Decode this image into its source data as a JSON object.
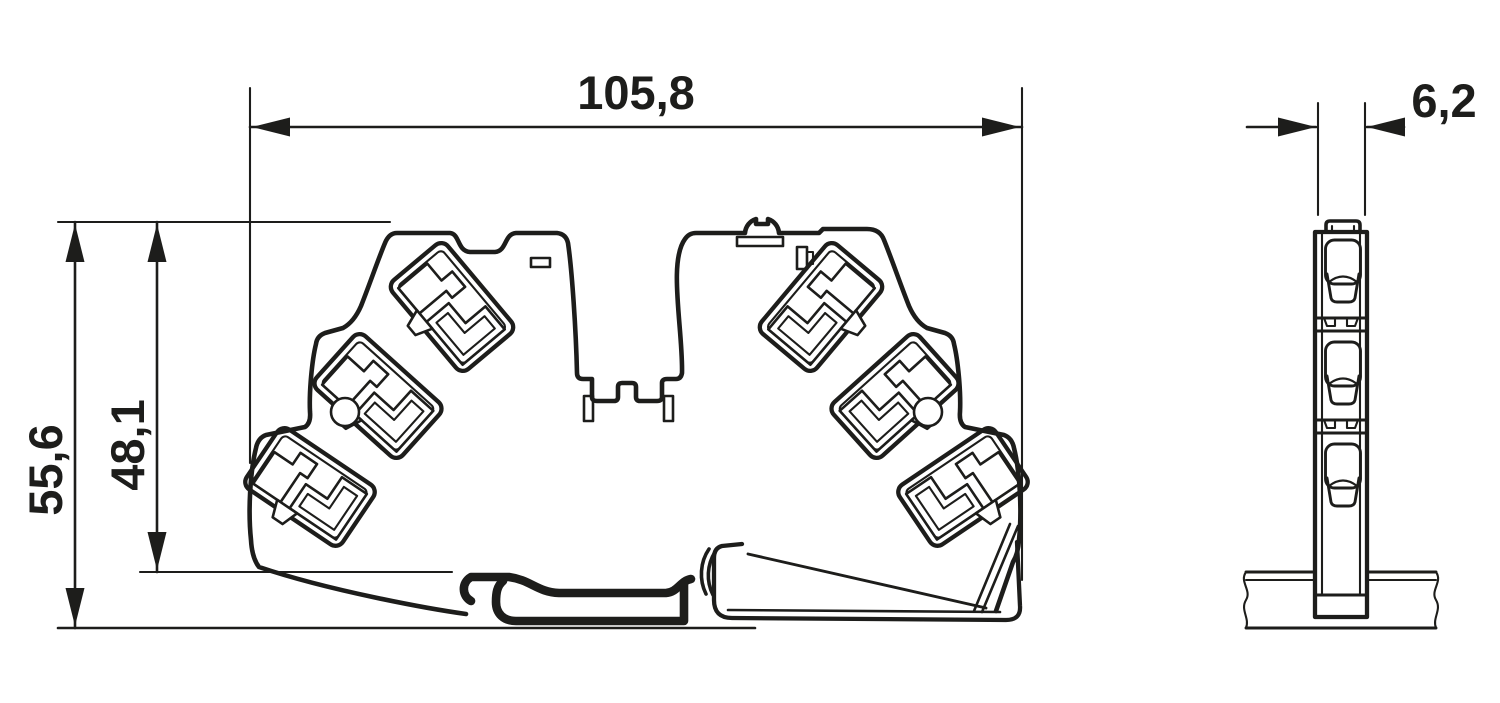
{
  "drawing": {
    "background_color": "#ffffff",
    "line_color": "#1d1d1b",
    "dimensions": {
      "front_width": {
        "label": "105,8"
      },
      "front_height_outer": {
        "label": "55,6"
      },
      "front_height_inner": {
        "label": "48,1"
      },
      "side_width": {
        "label": "6,2"
      }
    }
  }
}
